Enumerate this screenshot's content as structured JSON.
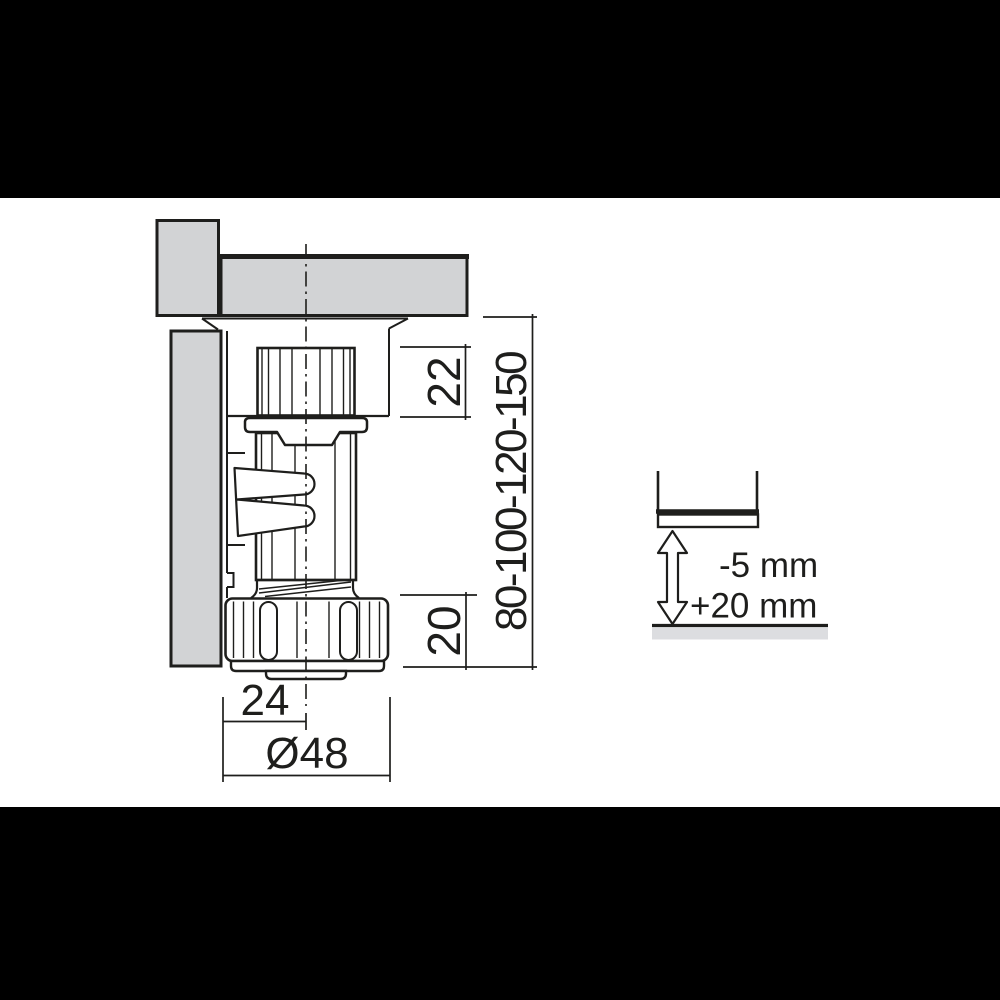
{
  "drawing": {
    "dimension_labels": {
      "dowel_height": "22",
      "foot_nut_height": "20",
      "leg_height_range": "80-100-120-150",
      "mount_offset": "24",
      "foot_diameter": "Ø48"
    },
    "adjustment": {
      "down_label": "-5 mm",
      "up_label": "+20 mm"
    },
    "colors": {
      "line": "#1e1e1c",
      "panel_fill": "#d2d3d5",
      "floor_fill": "#dcdde0",
      "background": "#ffffff",
      "letterbox": "#000000"
    }
  }
}
